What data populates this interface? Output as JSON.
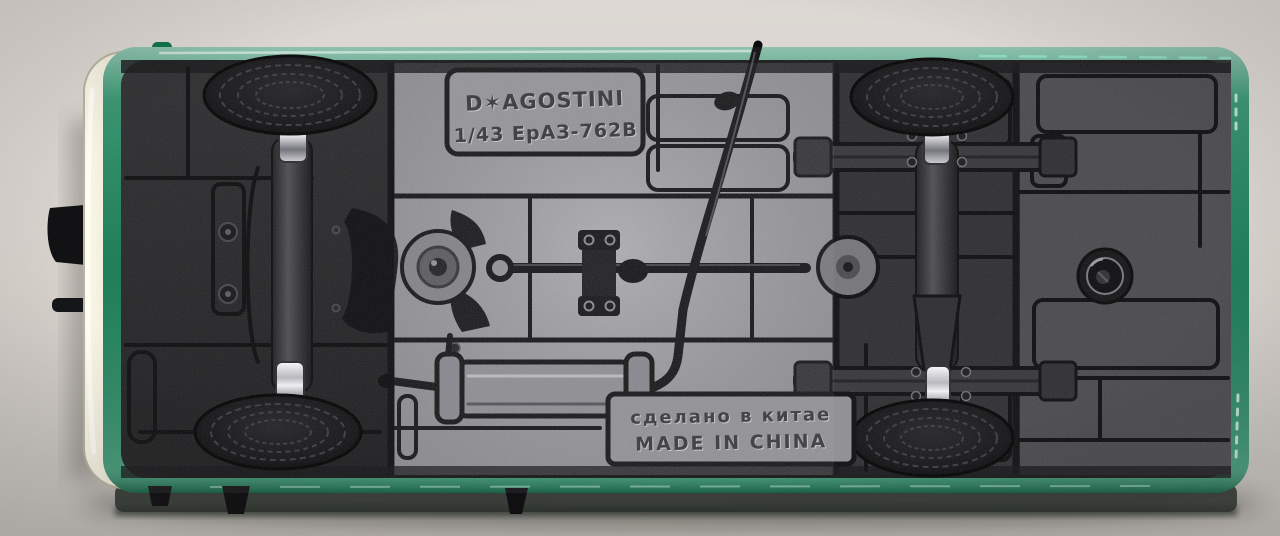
{
  "scene": {
    "description": "Photograph of the underside of a diecast model van on a gray backdrop",
    "colors": {
      "backdrop": "#d8d3cd",
      "body_green": "#15845a",
      "trim_cream": "#ece7d5",
      "chassis_dark": "#232325",
      "chassis_metal": "#96959a",
      "chrome": "#e9e9ec",
      "tire": "#121214"
    }
  },
  "markings": {
    "brand": "D✶AGOSTINI",
    "scale_and_model": "1/43 ЕрАЗ-762В",
    "made_in_ru": "сделано в китае",
    "made_in_en": "MADE IN CHINA"
  }
}
